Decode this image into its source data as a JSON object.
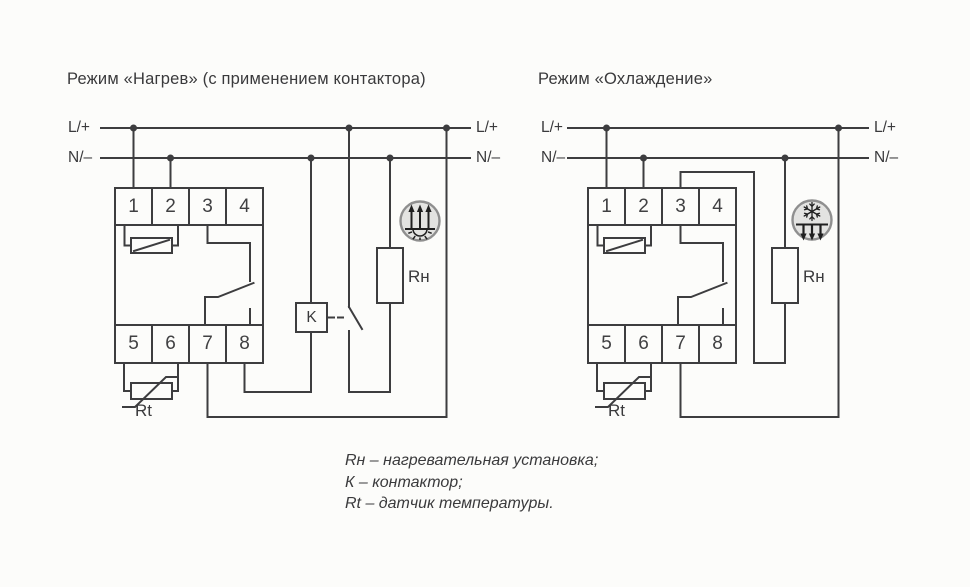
{
  "colors": {
    "background": "#fcfcfa",
    "line": "#3d3d3f",
    "text": "#3a3a3c",
    "icon_fill": "#e3e3e1",
    "icon_ring": "#8f8f8f"
  },
  "left_diagram": {
    "title": "Режим «Нагрев» (с применением контактора)",
    "bus_labels": {
      "line_left": "L/+",
      "line_right": "L/+",
      "neutral_left": "N/–",
      "neutral_right": "N/–"
    },
    "terminals_top": [
      "1",
      "2",
      "3",
      "4"
    ],
    "terminals_bottom": [
      "5",
      "6",
      "7",
      "8"
    ],
    "contactor_label": "K",
    "heater_label": "Rн",
    "sensor_label": "Rt",
    "icon_name": "heating-icon"
  },
  "right_diagram": {
    "title": "Режим «Охлаждение»",
    "bus_labels": {
      "line_left": "L/+",
      "line_right": "L/+",
      "neutral_left": "N/–",
      "neutral_right": "N/–"
    },
    "terminals_top": [
      "1",
      "2",
      "3",
      "4"
    ],
    "terminals_bottom": [
      "5",
      "6",
      "7",
      "8"
    ],
    "heater_label": "Rн",
    "sensor_label": "Rt",
    "icon_name": "cooling-icon"
  },
  "legend": {
    "line1": "Rн – нагревательная установка;",
    "line2": "К – контактор;",
    "line3": "Rt – датчик температуры."
  }
}
